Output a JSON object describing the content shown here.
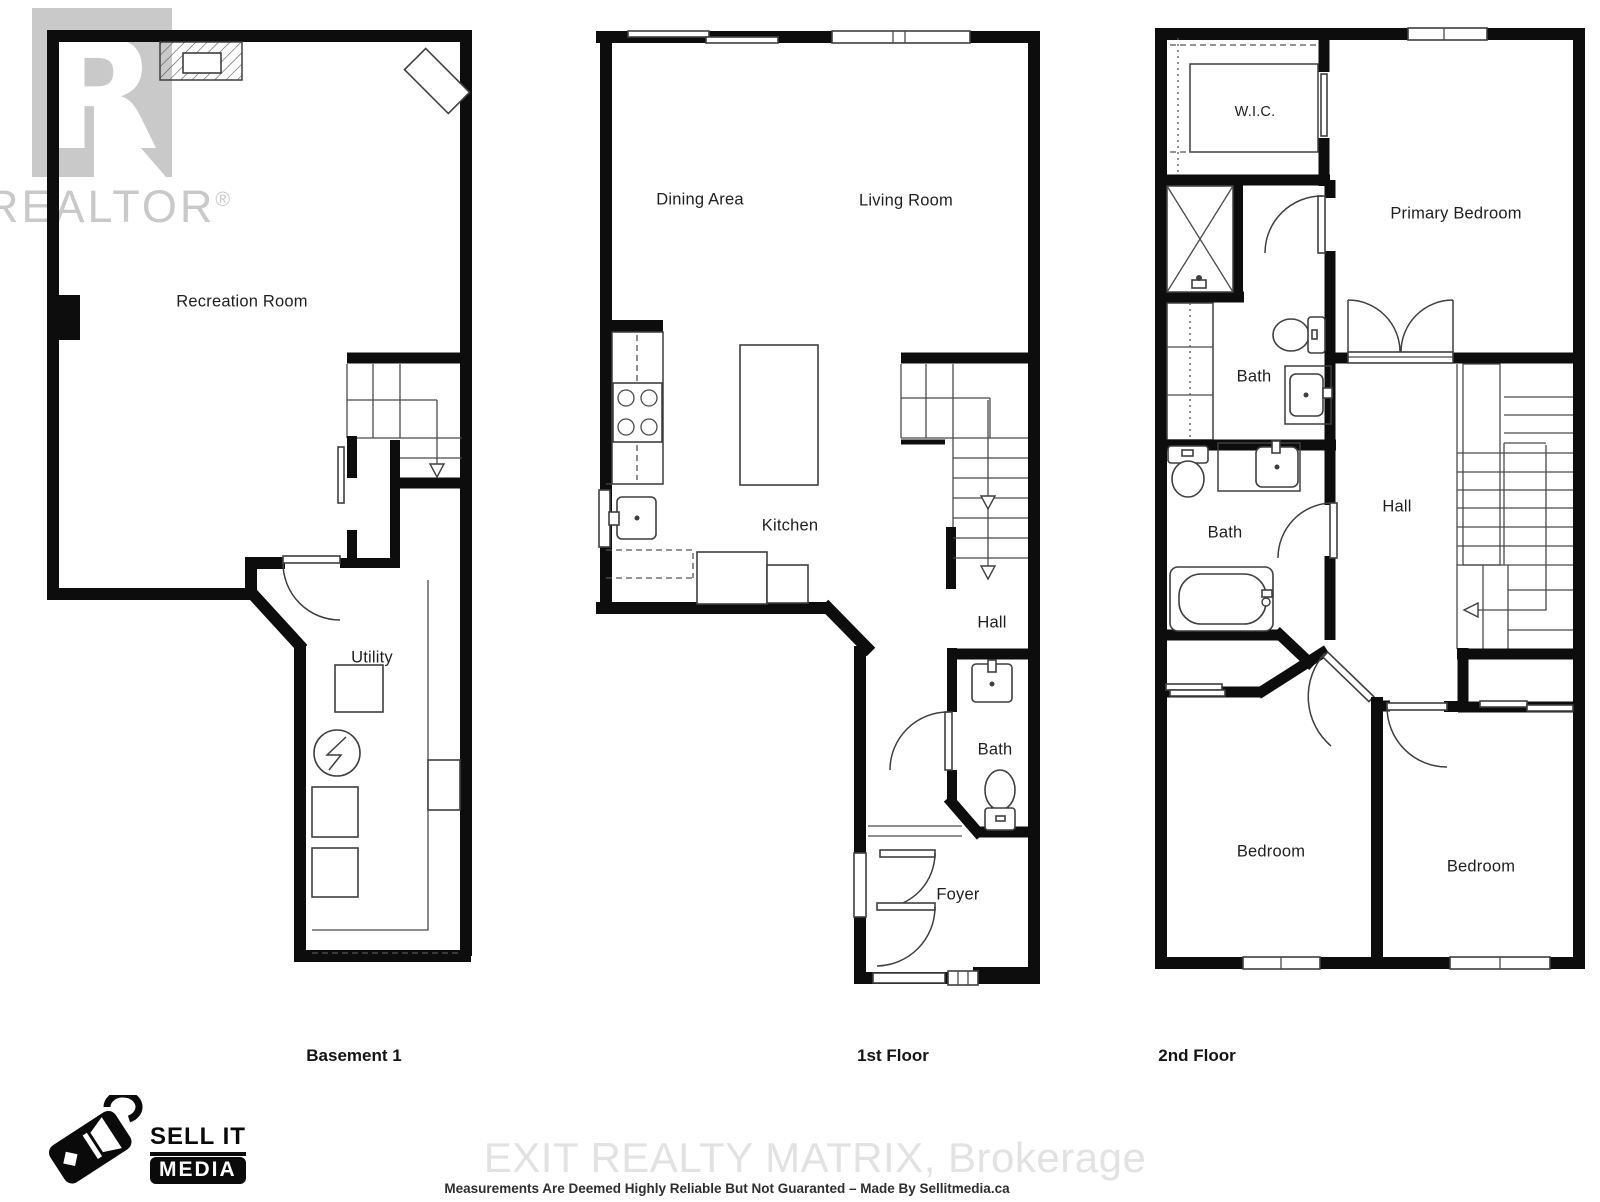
{
  "watermarks": {
    "realtor_logo_letter": "R",
    "realtor_text": "REALTOR",
    "registered_mark": "®",
    "brokerage_text": "EXIT REALTY MATRIX, Brokerage"
  },
  "branding": {
    "logo_line1": "SELL IT",
    "logo_line2": "MEDIA",
    "icon": "price-tag-camera-icon"
  },
  "footer": {
    "disclaimer": "Measurements Are Deemed Highly Reliable But Not Guaranted – Made By Sellitmedia.ca"
  },
  "floors": {
    "basement": {
      "title": "Basement 1",
      "labels": {
        "recreation": "Recreation Room",
        "utility": "Utility"
      }
    },
    "first": {
      "title": "1st Floor",
      "labels": {
        "dining": "Dining Area",
        "living": "Living Room",
        "kitchen": "Kitchen",
        "hall": "Hall",
        "bath": "Bath",
        "foyer": "Foyer"
      }
    },
    "second": {
      "title": "2nd Floor",
      "labels": {
        "wic": "W.I.C.",
        "primary": "Primary Bedroom",
        "ensuite_bath": "Bath",
        "main_bath": "Bath",
        "hall": "Hall",
        "bedroom_left": "Bedroom",
        "bedroom_right": "Bedroom"
      }
    }
  },
  "colors": {
    "wall": "#0d0d0d",
    "fixture_line": "#3f3f3f",
    "watermark_gray": "#c9c9c9",
    "brokerage_gray": "#e2e2e2",
    "label_text": "#1f1f1f",
    "background": "#ffffff"
  }
}
